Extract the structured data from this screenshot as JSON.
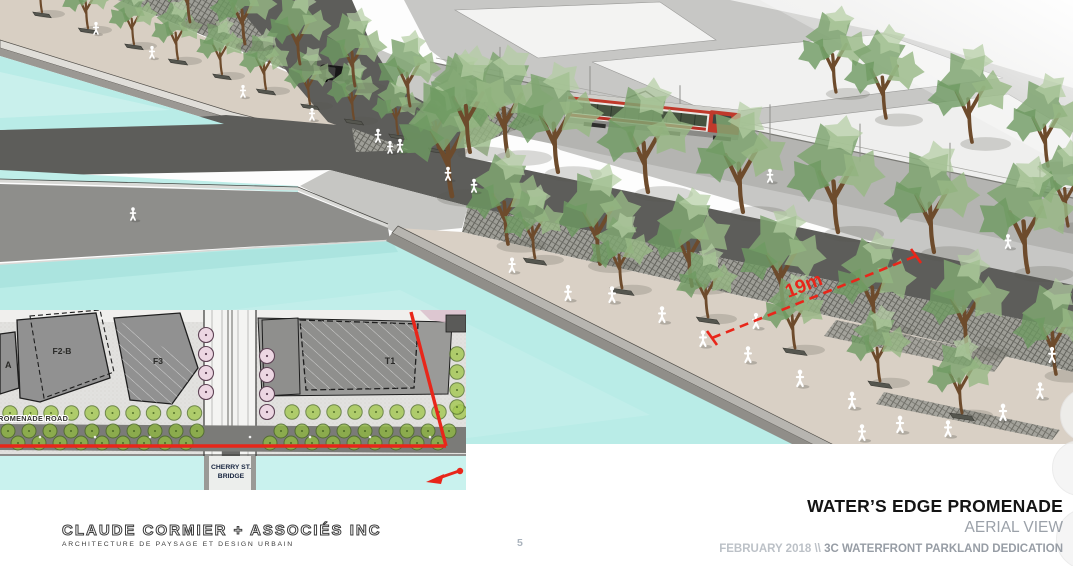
{
  "slide": {
    "page_number": "5",
    "footer_right": {
      "title": "WATER’S EDGE PROMENADE",
      "subtitle": "AERIAL VIEW",
      "date_prefix": "FEBRUARY 2018 \\\\ ",
      "project": "3C WATERFRONT PARKLAND DEDICATION"
    },
    "firm": {
      "name": "CLAUDE CORMIER + ASSOCIÉS INC",
      "tagline": "ARCHITECTURE DE PAYSAGE ET DESIGN URBAIN"
    }
  },
  "aerial": {
    "dimension_label": "19m"
  },
  "inset": {
    "building_a": "A",
    "building_f2b": "F2-B",
    "building_f3": "F3",
    "building_t1": "T1",
    "road_label": "PROMENADE ROAD",
    "bridge_label_line1": "CHERRY ST.",
    "bridge_label_line2": "BRIDGE"
  },
  "colors": {
    "water": "#b9ece7",
    "annotation_red": "#e8261a",
    "promenade_paving": "#d9d0c5",
    "canopy_green": "#7fa571",
    "asphalt_dark": "#5d5d5a",
    "title_text": "#141414",
    "muted_text": "#9ba1a9"
  }
}
